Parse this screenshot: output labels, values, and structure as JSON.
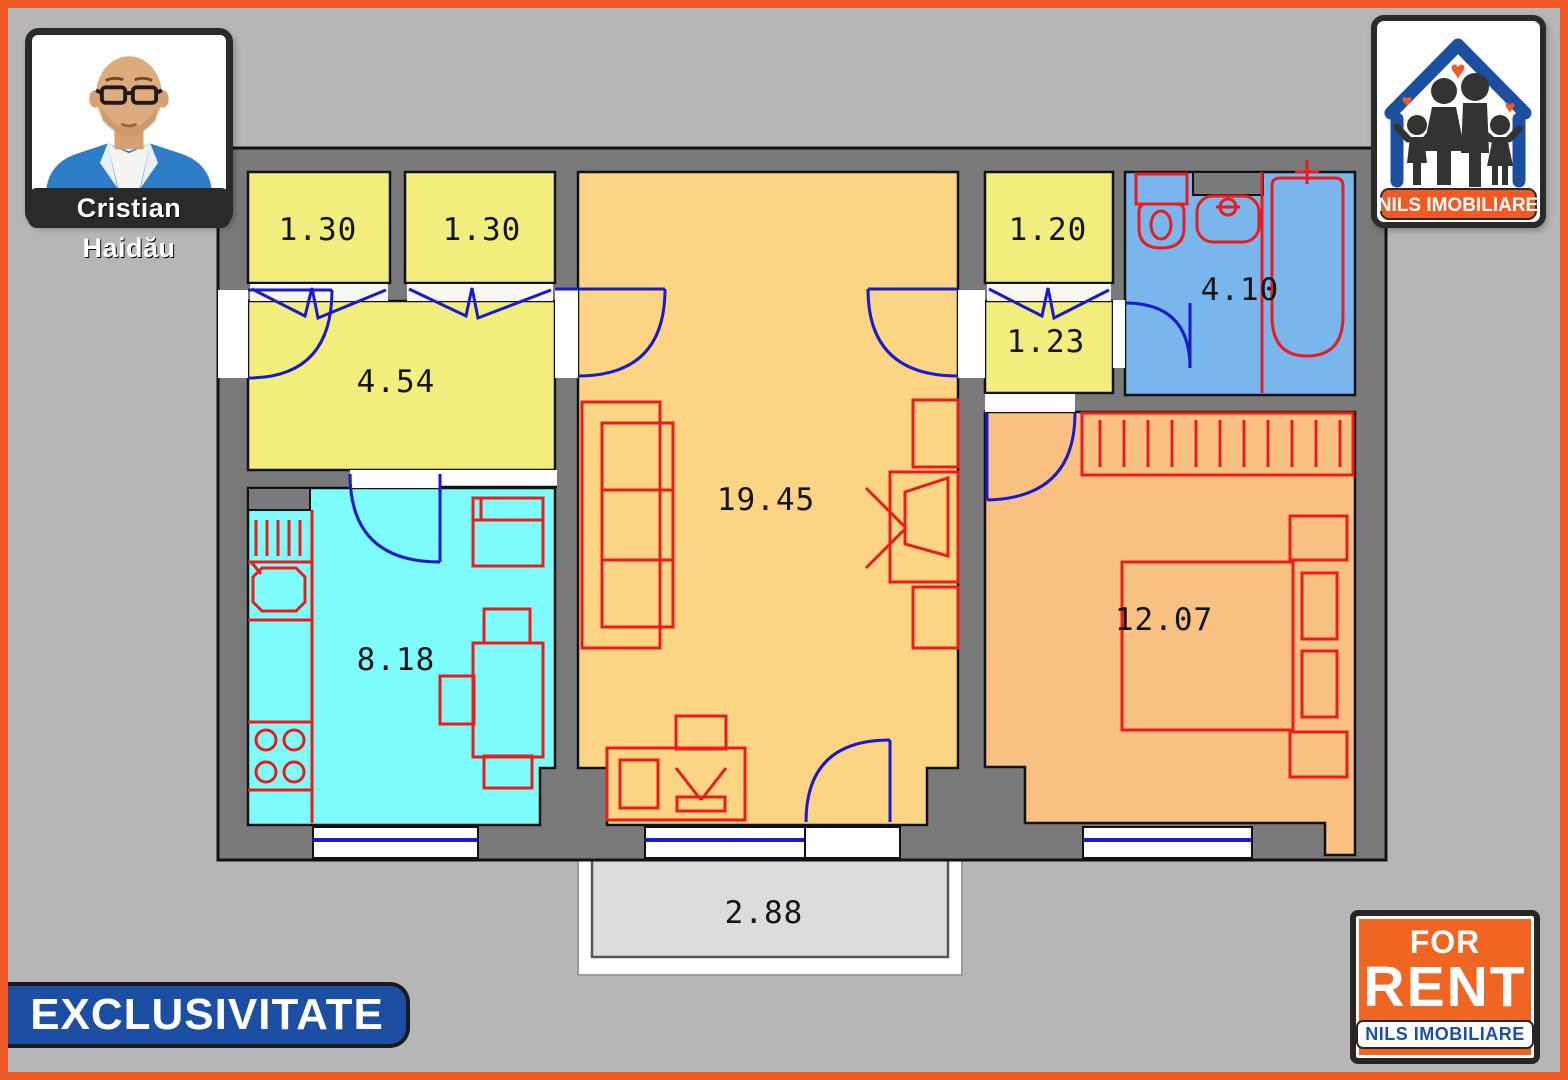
{
  "agent": {
    "name": "Cristian Haidău"
  },
  "logo": {
    "brand": "NILS IMOBILIARE"
  },
  "exclusivity_banner": {
    "label": "EXCLUSIVITATE"
  },
  "rent_badge": {
    "line1": "FOR",
    "line2": "RENT",
    "brand": "NILS IMOBILIARE"
  },
  "floorplan": {
    "rooms": [
      {
        "id": "closet-left-a",
        "area": "1.30"
      },
      {
        "id": "closet-left-b",
        "area": "1.30"
      },
      {
        "id": "hallway",
        "area": "4.54"
      },
      {
        "id": "kitchen",
        "area": "8.18"
      },
      {
        "id": "living-room",
        "area": "19.45"
      },
      {
        "id": "closet-right",
        "area": "1.20"
      },
      {
        "id": "hall-right",
        "area": "1.23"
      },
      {
        "id": "bathroom",
        "area": "4.10"
      },
      {
        "id": "bedroom",
        "area": "12.07"
      },
      {
        "id": "balcony",
        "area": "2.88"
      }
    ]
  },
  "colors": {
    "frame_orange": "#F15A24",
    "banner_blue": "#1C4FA3",
    "wall_gray": "#7A7A7A",
    "closet_yellow": "#F2EE7D",
    "living_tan": "#FBD584",
    "bedroom_orange": "#F9C181",
    "kitchen_cyan": "#7EFCFC",
    "bath_blue": "#79B6EE",
    "balcony_gray": "#DCDCDC",
    "furniture_red": "#EA1C1C",
    "door_blue": "#1A1ACC"
  }
}
